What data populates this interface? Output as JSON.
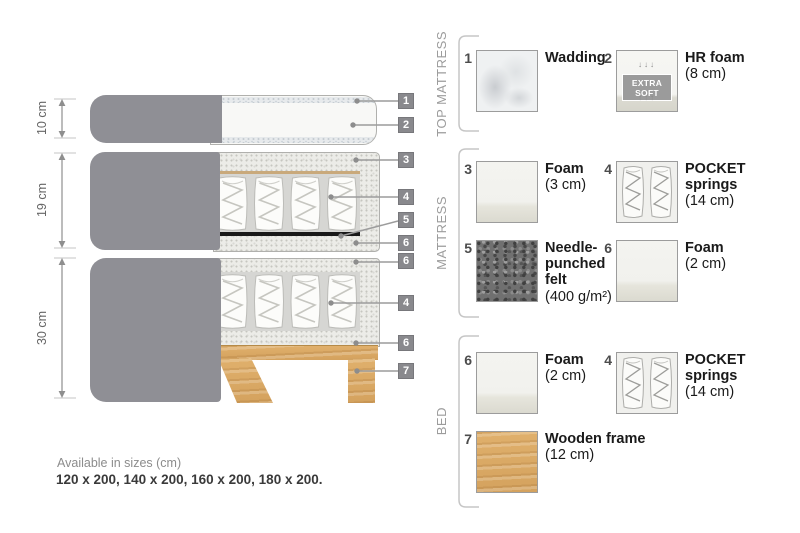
{
  "diagram": {
    "sections": [
      {
        "label": "10 cm"
      },
      {
        "label": "19 cm"
      },
      {
        "label": "30 cm"
      }
    ],
    "callouts": [
      "1",
      "2",
      "3",
      "4",
      "5",
      "6",
      "6",
      "4",
      "6",
      "7"
    ]
  },
  "legend": {
    "groups": [
      {
        "title": "TOP MATTRESS",
        "items": [
          {
            "num": "1",
            "name": "Wadding",
            "detail": ""
          },
          {
            "num": "2",
            "name": "HR foam",
            "detail": "(8 cm)",
            "badge": "EXTRA SOFT",
            "arrows_down": "↓↓↓",
            "arrows_up": "↑↑↑"
          }
        ]
      },
      {
        "title": "MATTRESS",
        "items": [
          {
            "num": "3",
            "name": "Foam",
            "detail": "(3 cm)"
          },
          {
            "num": "4",
            "name": "POCKET springs",
            "detail": "(14 cm)"
          },
          {
            "num": "5",
            "name": "Needle-punched felt",
            "detail": "(400 g/m²)"
          },
          {
            "num": "6",
            "name": "Foam",
            "detail": "(2 cm)"
          }
        ]
      },
      {
        "title": "BED",
        "items": [
          {
            "num": "6",
            "name": "Foam",
            "detail": "(2 cm)"
          },
          {
            "num": "4",
            "name": "POCKET springs",
            "detail": "(14 cm)"
          },
          {
            "num": "7",
            "name": "Wooden frame",
            "detail": "(12 cm)"
          }
        ]
      }
    ]
  },
  "footer": {
    "sizes_title": "Available in sizes (cm)",
    "sizes_list": "120 x 200, 140 x 200, 160 x 200, 180 x 200."
  },
  "colors": {
    "fabric_gray": "#8f8f95",
    "callout_gray": "#89898d",
    "wood": "#dcab68",
    "felt_dark": "#707070",
    "line_gray": "#9c9c9c"
  }
}
